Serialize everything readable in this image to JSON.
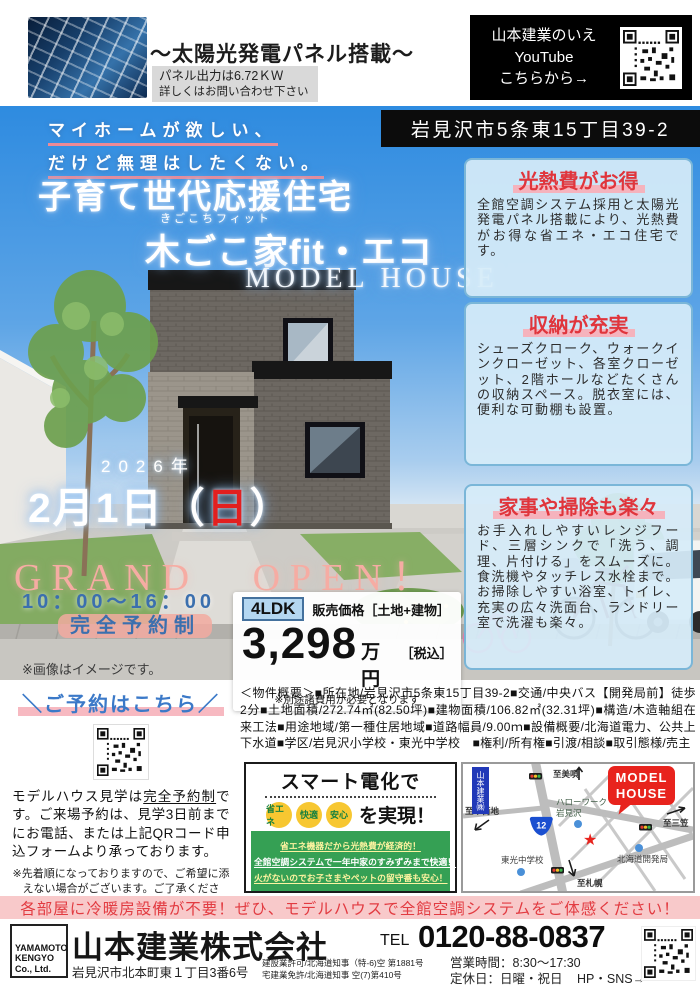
{
  "header": {
    "solar_title": "～太陽光発電パネル搭載～",
    "solar_note1": "パネル出力は6.72ＫＷ",
    "solar_note2": "詳しくはお問い合わせ下さい",
    "youtube": {
      "line1": "山本建業のいえ",
      "line2": "YouTube",
      "line3": "こちらから→"
    }
  },
  "address_banner": "岩見沢市5条東15丁目39-2",
  "hero": {
    "catch_line1": "マイホームが欲しい、",
    "catch_line2": "だけど無理はしたくない。",
    "title_main": "子育て世代応援住宅",
    "title_ruby": "きごこちフィット",
    "title_sub": "木ごこ家fit・エコ",
    "title_en": "MODEL HOUSE",
    "image_note": "※画像はイメージです。"
  },
  "open_info": {
    "year": "2026年",
    "date_pre": "2月1日（",
    "date_day": "日",
    "date_post": "）",
    "grand_open": "GRAND OPEN！",
    "hours": "10：00～16：00",
    "reservation": "完全予約制"
  },
  "price": {
    "layout": "4LDK",
    "label": "販売価格［土地+建物］",
    "amount": "3,298",
    "unit": "万円",
    "tax": "［税込］",
    "note": "※別途諸費用が必要となります"
  },
  "features": [
    {
      "title": "光熱費がお得",
      "body": "全館空調システム採用と太陽光発電パネル搭載により、光熱費がお得な省エネ・エコ住宅です。"
    },
    {
      "title": "収納が充実",
      "body": "シューズクローク、ウォークインクローゼット、各室クローゼット、2階ホールなどたくさんの収納スペース。脱衣室には、便利な可動棚も設置。"
    },
    {
      "title": "家事や掃除も楽々",
      "body": "お手入れしやすいレンジフード、三層シンクで「洗う、調理、片付ける」をスムーズに。食洗機やタッチレス水栓まで。お掃除しやすい浴室、トイレ、充実の広々洗面台、ランドリー室で洗濯も楽々。"
    }
  ],
  "overview": {
    "heading": "＜物件概要＞",
    "body": "■所在地/岩見沢市5条東15丁目39-2■交通/中央バス【開発局前】徒歩2分■土地面積/272.74㎡(82.50坪)■建物面積/106.82㎡(32.31坪)■構造/木造軸組在来工法■用途地域/第一種住居地域■道路幅員/9.00ｍ■設備概要/北海道電力、公共上下水道■学区/岩見沢小学校・東光中学校　■権利/所有権■引渡/相談■取引態様/売主"
  },
  "reserve": {
    "title": "＼ご予約はこちら／",
    "body_pre": "モデルハウス見学は",
    "body_em": "完全予約制",
    "body_post": "です。ご来場予約は、見学3日前までにお電話、または上記QRコード申込フォームより承っております。",
    "note1": "※先着順になっておりますので、ご希望に添",
    "note2": "えない場合がございます。ご了承ください。"
  },
  "smart": {
    "title": "スマート電化で",
    "badges": [
      "省エネ",
      "快適",
      "安心"
    ],
    "suffix": "を実現！",
    "lines": [
      "省エネ機器だから光熱費が経済的！",
      "全館空調システムで一年中家のすみずみまで快適！",
      "火がないのでお子さまやペットの留守番も安心！"
    ]
  },
  "map": {
    "company_sign": "山本建業㈱",
    "dest_north": "至美唄",
    "dest_west": "至市街地",
    "dest_east": "至三笠",
    "dest_south": "至札幌",
    "poi_hellowork1": "ハローワーク",
    "poi_hellowork2": "岩見沢",
    "poi_school": "東光中学校",
    "poi_bureau": "北海道開発局",
    "route_number": "12",
    "model_house1": "MODEL",
    "model_house2": "HOUSE"
  },
  "banner": "各部屋に冷暖房設備が不要！ぜひ、モデルハウスで全館空調システムをご体感ください！",
  "footer": {
    "logo_line1": "YAMAMOTO",
    "logo_line2": "KENGYO",
    "logo_line3": "Co., Ltd.",
    "company": "山本建業株式会社",
    "address": "岩見沢市北本町東１丁目3番6号",
    "license1": "建設業許可/北海道知事（特-6)空 第1881号",
    "license2": "宅建業免許/北海道知事 空(7)第410号",
    "tel_label": "TEL",
    "tel_number": "0120-88-0837",
    "hours": "営業時間：8:30～17:30",
    "holiday": "定休日：日曜・祝日",
    "sns": "HP・SNS→"
  },
  "colors": {
    "accent_red": "#e0353c",
    "accent_pink": "#f5b3bd",
    "accent_blue": "#3b6fae",
    "panel_blue": "#d6ecf9",
    "green": "#35a054",
    "badge_yellow": "#f7c731"
  }
}
